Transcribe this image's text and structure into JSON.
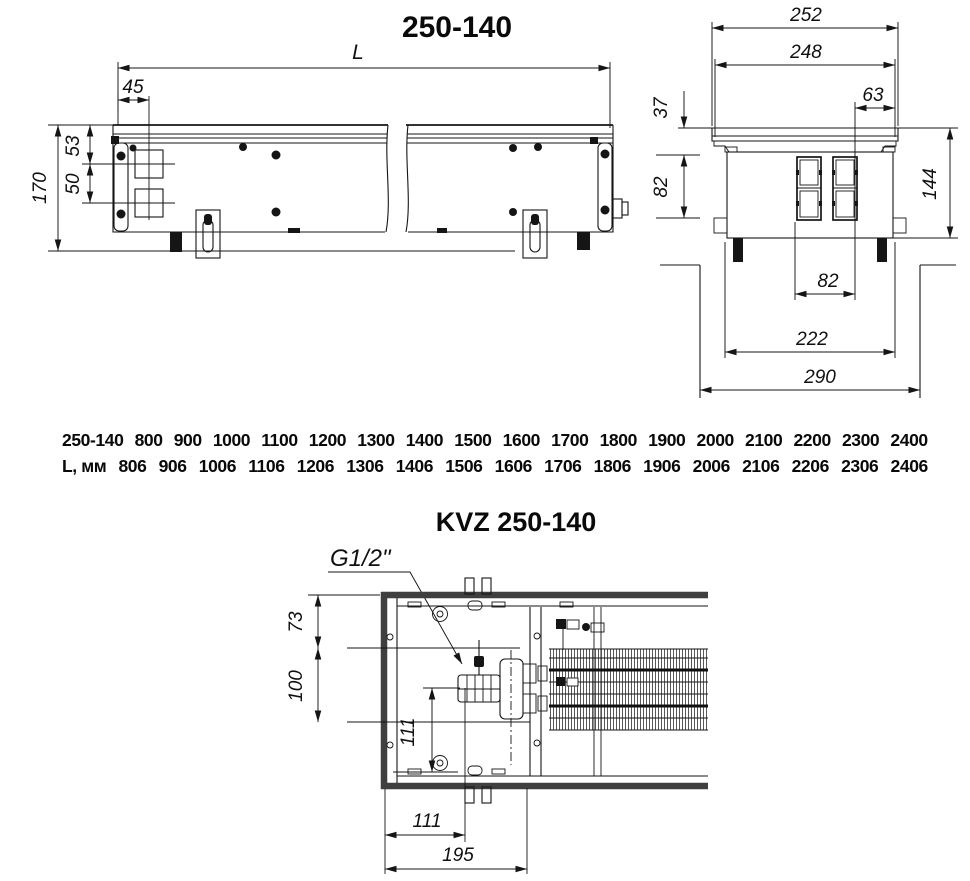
{
  "side_view": {
    "title": "250-140",
    "dim_L": "L",
    "dim_45": "45",
    "dim_53": "53",
    "dim_50": "50",
    "dim_170": "170"
  },
  "cross_section": {
    "dim_252": "252",
    "dim_248": "248",
    "dim_63": "63",
    "dim_37": "37",
    "dim_82_left": "82",
    "dim_144": "144",
    "dim_82_bottom": "82",
    "dim_222": "222",
    "dim_290": "290"
  },
  "size_table": {
    "row_models": [
      "250-140",
      "800",
      "900",
      "1000",
      "1100",
      "1200",
      "1300",
      "1400",
      "1500",
      "1600",
      "1700",
      "1800",
      "1900",
      "2000",
      "2100",
      "2200",
      "2300",
      "2400"
    ],
    "row_lengths": [
      "L, мм",
      "806",
      "906",
      "1006",
      "1106",
      "1206",
      "1306",
      "1406",
      "1506",
      "1606",
      "1706",
      "1806",
      "1906",
      "2006",
      "2106",
      "2206",
      "2306",
      "2406"
    ]
  },
  "plan_view": {
    "title": "KVZ 250-140",
    "thread_label": "G1/2\"",
    "dim_73": "73",
    "dim_100": "100",
    "dim_111_v": "111",
    "dim_111_h": "111",
    "dim_195": "195"
  }
}
